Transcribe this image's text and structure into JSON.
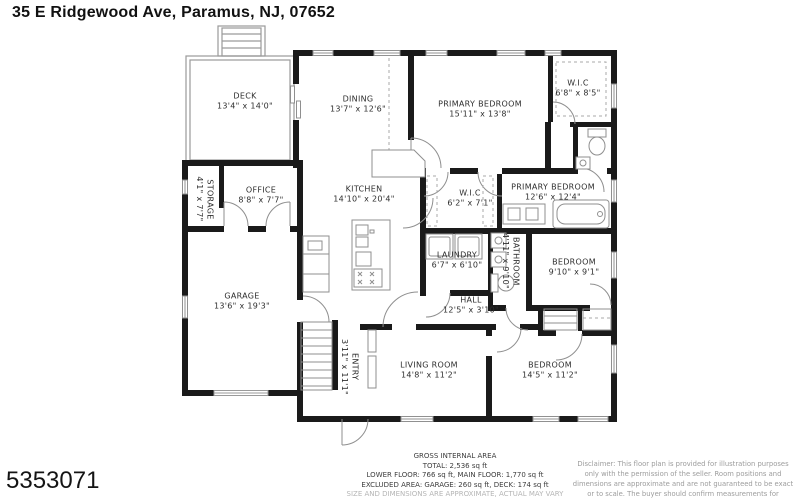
{
  "header": {
    "title": "35 E Ridgewood Ave, Paramus, NJ, 07652"
  },
  "rooms": [
    {
      "name": "DECK",
      "dims": "13'4\" x 14'0\""
    },
    {
      "name": "DINING",
      "dims": "13'7\" x 12'6\""
    },
    {
      "name": "PRIMARY BEDROOM",
      "dims": "15'11\" x 13'8\""
    },
    {
      "name": "W.I.C",
      "dims": "6'8\" x 8'5\""
    },
    {
      "name": "STORAGE",
      "dims": "4'1\" x 7'7\""
    },
    {
      "name": "OFFICE",
      "dims": "8'8\" x 7'7\""
    },
    {
      "name": "KITCHEN",
      "dims": "14'10\" x 20'4\""
    },
    {
      "name": "W.I.C",
      "dims": "6'2\" x 7'1\""
    },
    {
      "name": "PRIMARY BEDROOM",
      "dims": "12'6\" x 12'4\""
    },
    {
      "name": "LAUNDRY",
      "dims": "6'7\" x 6'10\""
    },
    {
      "name": "BATHROOM",
      "dims": "4'11\" x 9'10\""
    },
    {
      "name": "BEDROOM",
      "dims": "9'10\" x 9'1\""
    },
    {
      "name": "GARAGE",
      "dims": "13'6\" x 19'3\""
    },
    {
      "name": "HALL",
      "dims": "12'5\" x 3'10\""
    },
    {
      "name": "ENTRY",
      "dims": "3'11\" x 11'1\""
    },
    {
      "name": "LIVING ROOM",
      "dims": "14'8\" x 11'2\""
    },
    {
      "name": "BEDROOM",
      "dims": "14'5\" x 11'2\""
    }
  ],
  "footer": {
    "center": {
      "title": "GROSS INTERNAL AREA",
      "total": "TOTAL: 2,536 sq ft",
      "floors": "LOWER FLOOR: 766 sq ft, MAIN FLOOR: 1,770 sq ft",
      "excluded": "EXCLUDED AREA: GARAGE: 260 sq ft, DECK: 174 sq ft",
      "note": "SIZE AND DIMENSIONS ARE APPROXIMATE, ACTUAL MAY VARY"
    },
    "disclaimer": "Disclaimer: This floor plan is provided for illustration purposes only with the permission of the seller. Room positions and dimensions are approximate and are not guaranteed to be exact or to scale. The buyer should confirm measurements for accuracy.",
    "listing_id": "5353071"
  },
  "colors": {
    "wall": "#1a1a1a",
    "thin_line": "#8f8f8f",
    "text": "#2e2e2e"
  }
}
